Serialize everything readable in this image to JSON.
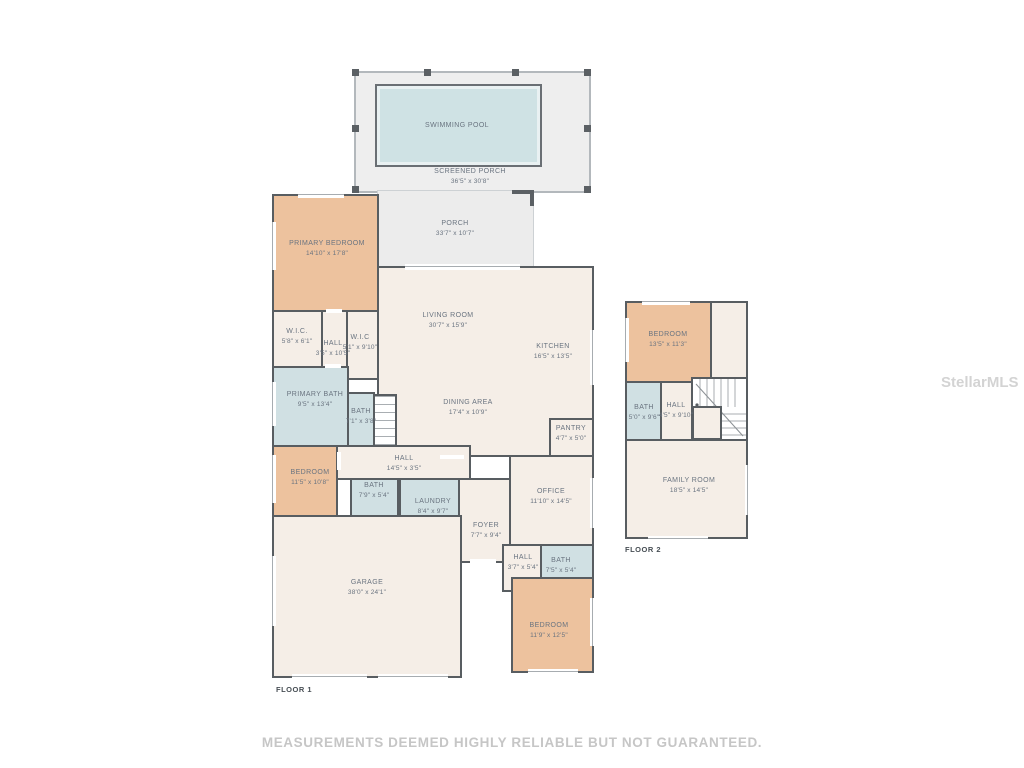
{
  "watermark": "StellarMLS",
  "footer": {
    "disclaimer": "MEASUREMENTS DEEMED HIGHLY RELIABLE BUT NOT GUARANTEED."
  },
  "colors": {
    "wall": "#585d61",
    "room_fill": "#f5eee7",
    "bedroom_fill": "#edc29e",
    "bath_fill": "#d0e0e3",
    "porch_fill": "#ececec",
    "pool_fill": "#cfe2e4",
    "label_text": "#6a7480"
  },
  "floor1": {
    "caption": "FLOOR 1",
    "swimming_pool": {
      "name": "SWIMMING POOL",
      "dims": ""
    },
    "screened_porch": {
      "name": "SCREENED PORCH",
      "dims": "36'5\" x 30'8\""
    },
    "porch": {
      "name": "PORCH",
      "dims": "33'7\" x 10'7\""
    },
    "primary_bedroom": {
      "name": "PRIMARY BEDROOM",
      "dims": "14'10\" x 17'8\""
    },
    "living_room": {
      "name": "LIVING ROOM",
      "dims": "30'7\" x 15'9\""
    },
    "kitchen": {
      "name": "KITCHEN",
      "dims": "16'5\" x 13'5\""
    },
    "wic_1": {
      "name": "W.I.C.",
      "dims": "5'8\" x 6'1\""
    },
    "hall_1": {
      "name": "HALL",
      "dims": "3'5\" x 10'5\""
    },
    "wic_2": {
      "name": "W.I.C",
      "dims": "5'1\" x 9'10\""
    },
    "primary_bath": {
      "name": "PRIMARY BATH",
      "dims": "9'5\" x 13'4\""
    },
    "bath_1": {
      "name": "BATH",
      "dims": "7'1\" x 3'8\""
    },
    "dining_area": {
      "name": "DINING AREA",
      "dims": "17'4\" x 10'9\""
    },
    "pantry": {
      "name": "PANTRY",
      "dims": "4'7\" x 5'0\""
    },
    "bedroom_2": {
      "name": "BEDROOM",
      "dims": "11'5\" x 10'8\""
    },
    "hall_2": {
      "name": "HALL",
      "dims": "14'5\" x 3'5\""
    },
    "bath_2": {
      "name": "BATH",
      "dims": "7'9\" x 5'4\""
    },
    "laundry": {
      "name": "LAUNDRY",
      "dims": "8'4\" x 9'7\""
    },
    "office": {
      "name": "OFFICE",
      "dims": "11'10\" x 14'5\""
    },
    "foyer": {
      "name": "FOYER",
      "dims": "7'7\" x 9'4\""
    },
    "hall_3": {
      "name": "HALL",
      "dims": "3'7\" x 5'4\""
    },
    "bath_3": {
      "name": "BATH",
      "dims": "7'5\" x 5'4\""
    },
    "garage": {
      "name": "GARAGE",
      "dims": "38'0\" x 24'1\""
    },
    "bedroom_3": {
      "name": "BEDROOM",
      "dims": "11'9\" x 12'5\""
    }
  },
  "floor2": {
    "caption": "FLOOR 2",
    "bedroom": {
      "name": "BEDROOM",
      "dims": "13'5\" x 11'3\""
    },
    "bath": {
      "name": "BATH",
      "dims": "5'0\" x 9'6\""
    },
    "hall": {
      "name": "HALL",
      "dims": "4'5\" x 9'10\""
    },
    "family_room": {
      "name": "FAMILY ROOM",
      "dims": "18'5\" x 14'5\""
    }
  }
}
